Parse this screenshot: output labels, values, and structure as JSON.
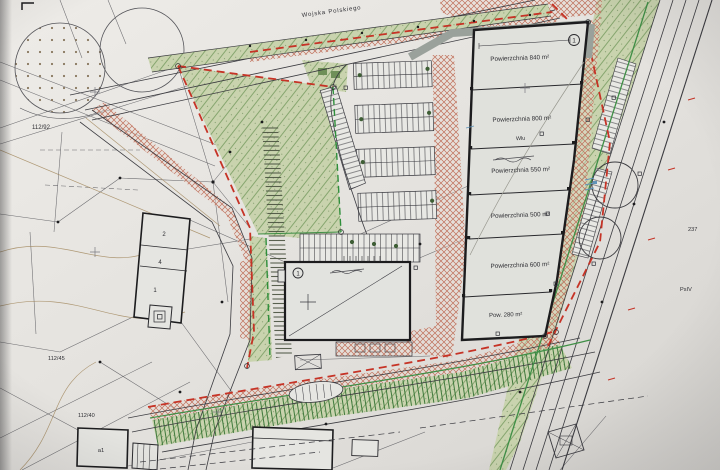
{
  "plan": {
    "street_name": "Wojska Polskiego",
    "warehouse": {
      "marker": "1",
      "units": [
        {
          "area": "Powierzchnia 840 m²"
        },
        {
          "area": "Powierzchnia 800 m²"
        },
        {
          "area": "Powierzchnia 550 m²"
        },
        {
          "area": "Powierzchnia 500 m²"
        },
        {
          "area": "Powierzchnia 600 m²"
        },
        {
          "area": "Pow. 280 m²"
        }
      ],
      "soil_note": "Wlu"
    },
    "office_building": {
      "marker": "1"
    },
    "existing_building_rooms": {
      "r1": "2",
      "r2": "4",
      "r3": "1"
    },
    "outbuilding_label": "a1",
    "parcels": {
      "p_112_92": "112/92",
      "p_112_45": "112/45",
      "p_112_40": "112/40",
      "p_237": "237",
      "p_psiv": "PsIV"
    }
  }
}
